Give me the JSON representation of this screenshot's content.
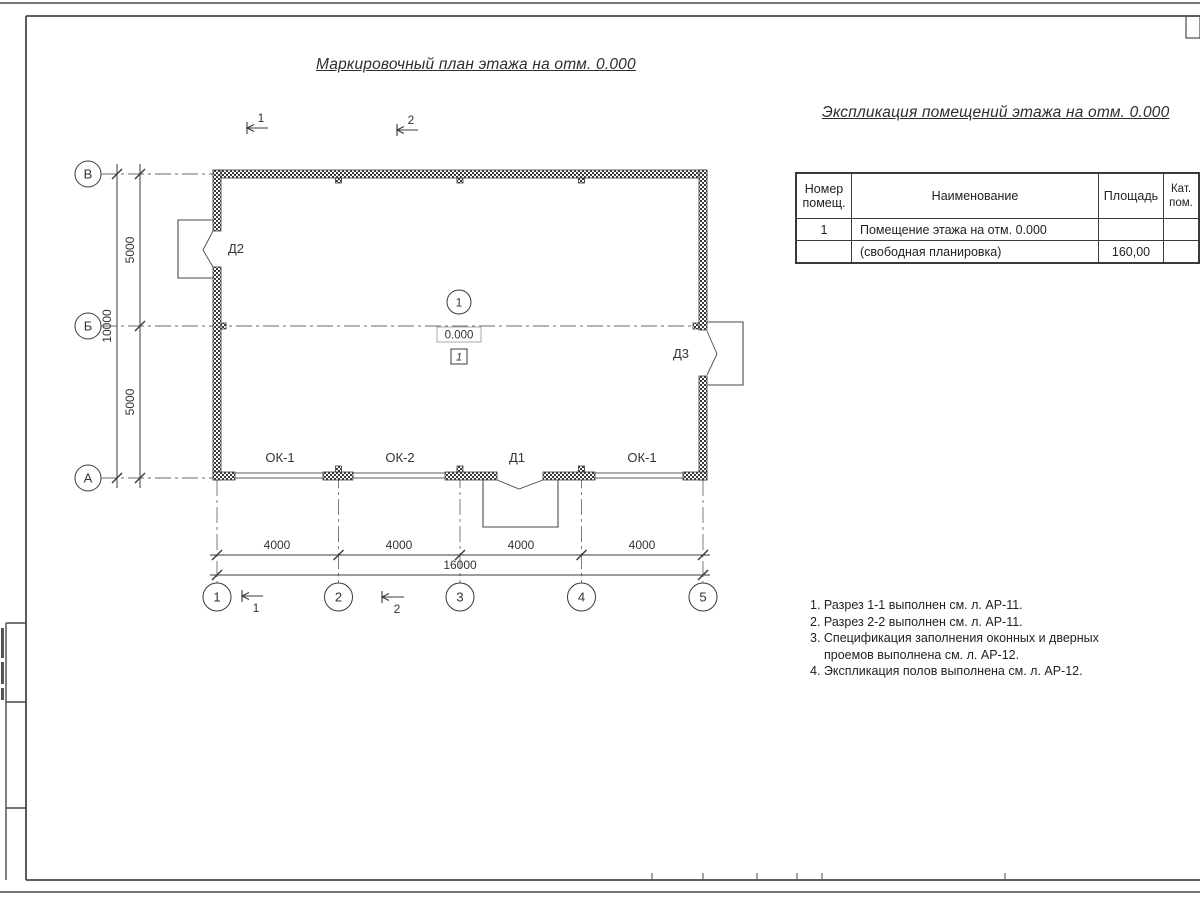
{
  "titles": {
    "plan": "Маркировочный план этажа на отм. 0.000",
    "explication": "Экспликация помещений этажа на отм. 0.000"
  },
  "table": {
    "headers": {
      "num1": "Номер",
      "num2": "помещ.",
      "name": "Наименование",
      "area": "Площадь",
      "cat1": "Кат.",
      "cat2": "пом."
    },
    "rows": [
      {
        "num": "1",
        "name": "Помещение этажа на отм. 0.000",
        "area": "",
        "cat": ""
      },
      {
        "num": "",
        "name": "(свободная планировка)",
        "area": "160,00",
        "cat": ""
      }
    ]
  },
  "notes": [
    "1. Разрез 1-1 выполнен см. л. АР-11.",
    "2. Разрез 2-2 выполнен см. л. АР-11.",
    "3. Спецификация заполнения оконных и дверных",
    "проемов выполнена см. л. АР-12.",
    "4. Экспликация полов выполнена см. л. АР-12."
  ],
  "plan": {
    "axes_rows": [
      "В",
      "Б",
      "А"
    ],
    "axes_cols": [
      "1",
      "2",
      "3",
      "4",
      "5"
    ],
    "dims_left": [
      "5000",
      "5000"
    ],
    "dim_left_total": "10000",
    "dims_bottom": [
      "4000",
      "4000",
      "4000",
      "4000"
    ],
    "dim_bottom_total": "16000",
    "sections": [
      "1",
      "2"
    ],
    "labels": {
      "d1": "Д1",
      "d2": "Д2",
      "d3": "Д3",
      "ok1a": "ОК-1",
      "ok2": "ОК-2",
      "ok1b": "ОК-1"
    },
    "room": {
      "number": "1",
      "elevation": "0.000",
      "floor": "1"
    }
  },
  "colors": {
    "ink": "#3a3a3a",
    "axis": "#6e6e6e",
    "light_box": "#a8a8a8"
  }
}
